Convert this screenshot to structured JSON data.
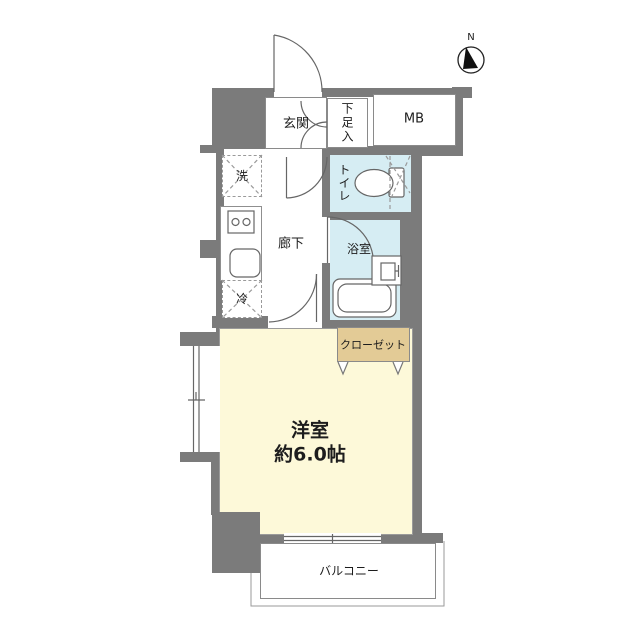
{
  "title": "apartment-floor-plan",
  "compass": {
    "north_label": "N"
  },
  "labels": {
    "genkan": "玄関",
    "shoe_cabinet": "下足入",
    "meter_box": "MB",
    "washing_machine": "洗",
    "toilet": "トイレ",
    "hallway": "廊下",
    "bathroom": "浴室",
    "refrigerator": "冷",
    "closet": "クローゼット",
    "bedroom_name": "洋室",
    "bedroom_size": "約6.0帖",
    "balcony": "バルコニー"
  },
  "colors": {
    "wall": "#7b7b7b",
    "water_room": "#d6edf3",
    "main_room": "#fdf9d9",
    "closet": "#e3cb96",
    "outline": "#8a8a8a",
    "background": "#ffffff"
  }
}
